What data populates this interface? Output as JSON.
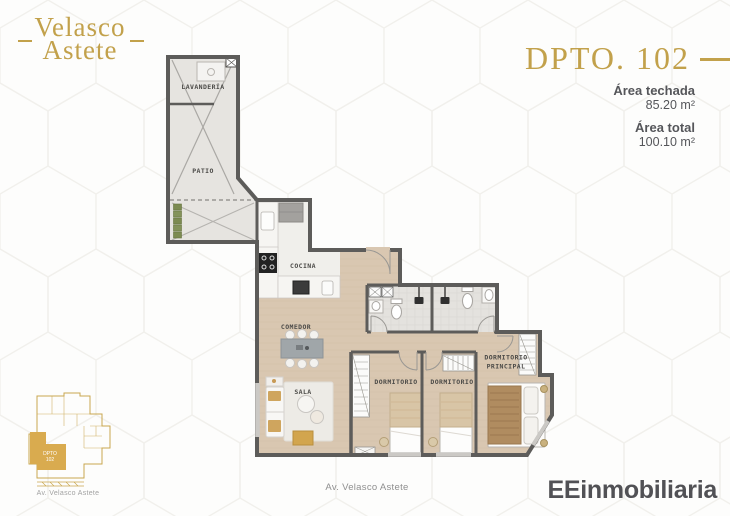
{
  "brand": {
    "line1": "Velasco",
    "line2": "Astete"
  },
  "unit": {
    "title": "DPTO. 102",
    "areas": [
      {
        "label": "Área techada",
        "value": "85.20 m²"
      },
      {
        "label": "Área total",
        "value": "100.10 m²"
      }
    ]
  },
  "plan": {
    "rooms": {
      "laundry": "LAVANDERÍA",
      "patio": "PATIO",
      "kitchen": "COCINA",
      "dining": "COMEDOR",
      "living": "SALA",
      "bedroom_a": "DORMITORIO",
      "bedroom_b": "DORMITORIO",
      "master_1": "DORMITORIO",
      "master_2": "PRINCIPAL"
    }
  },
  "keyplan": {
    "unit_1": "DPTO",
    "unit_2": "102",
    "caption": "Av. Velasco Astete"
  },
  "footer": {
    "street": "Av. Velasco Astete",
    "agency": "EEinmobiliaria"
  },
  "colors": {
    "gold": "#c2a14b",
    "wall": "#5d5c5a",
    "wood": "#d9c7b1",
    "text": "#55565a"
  }
}
